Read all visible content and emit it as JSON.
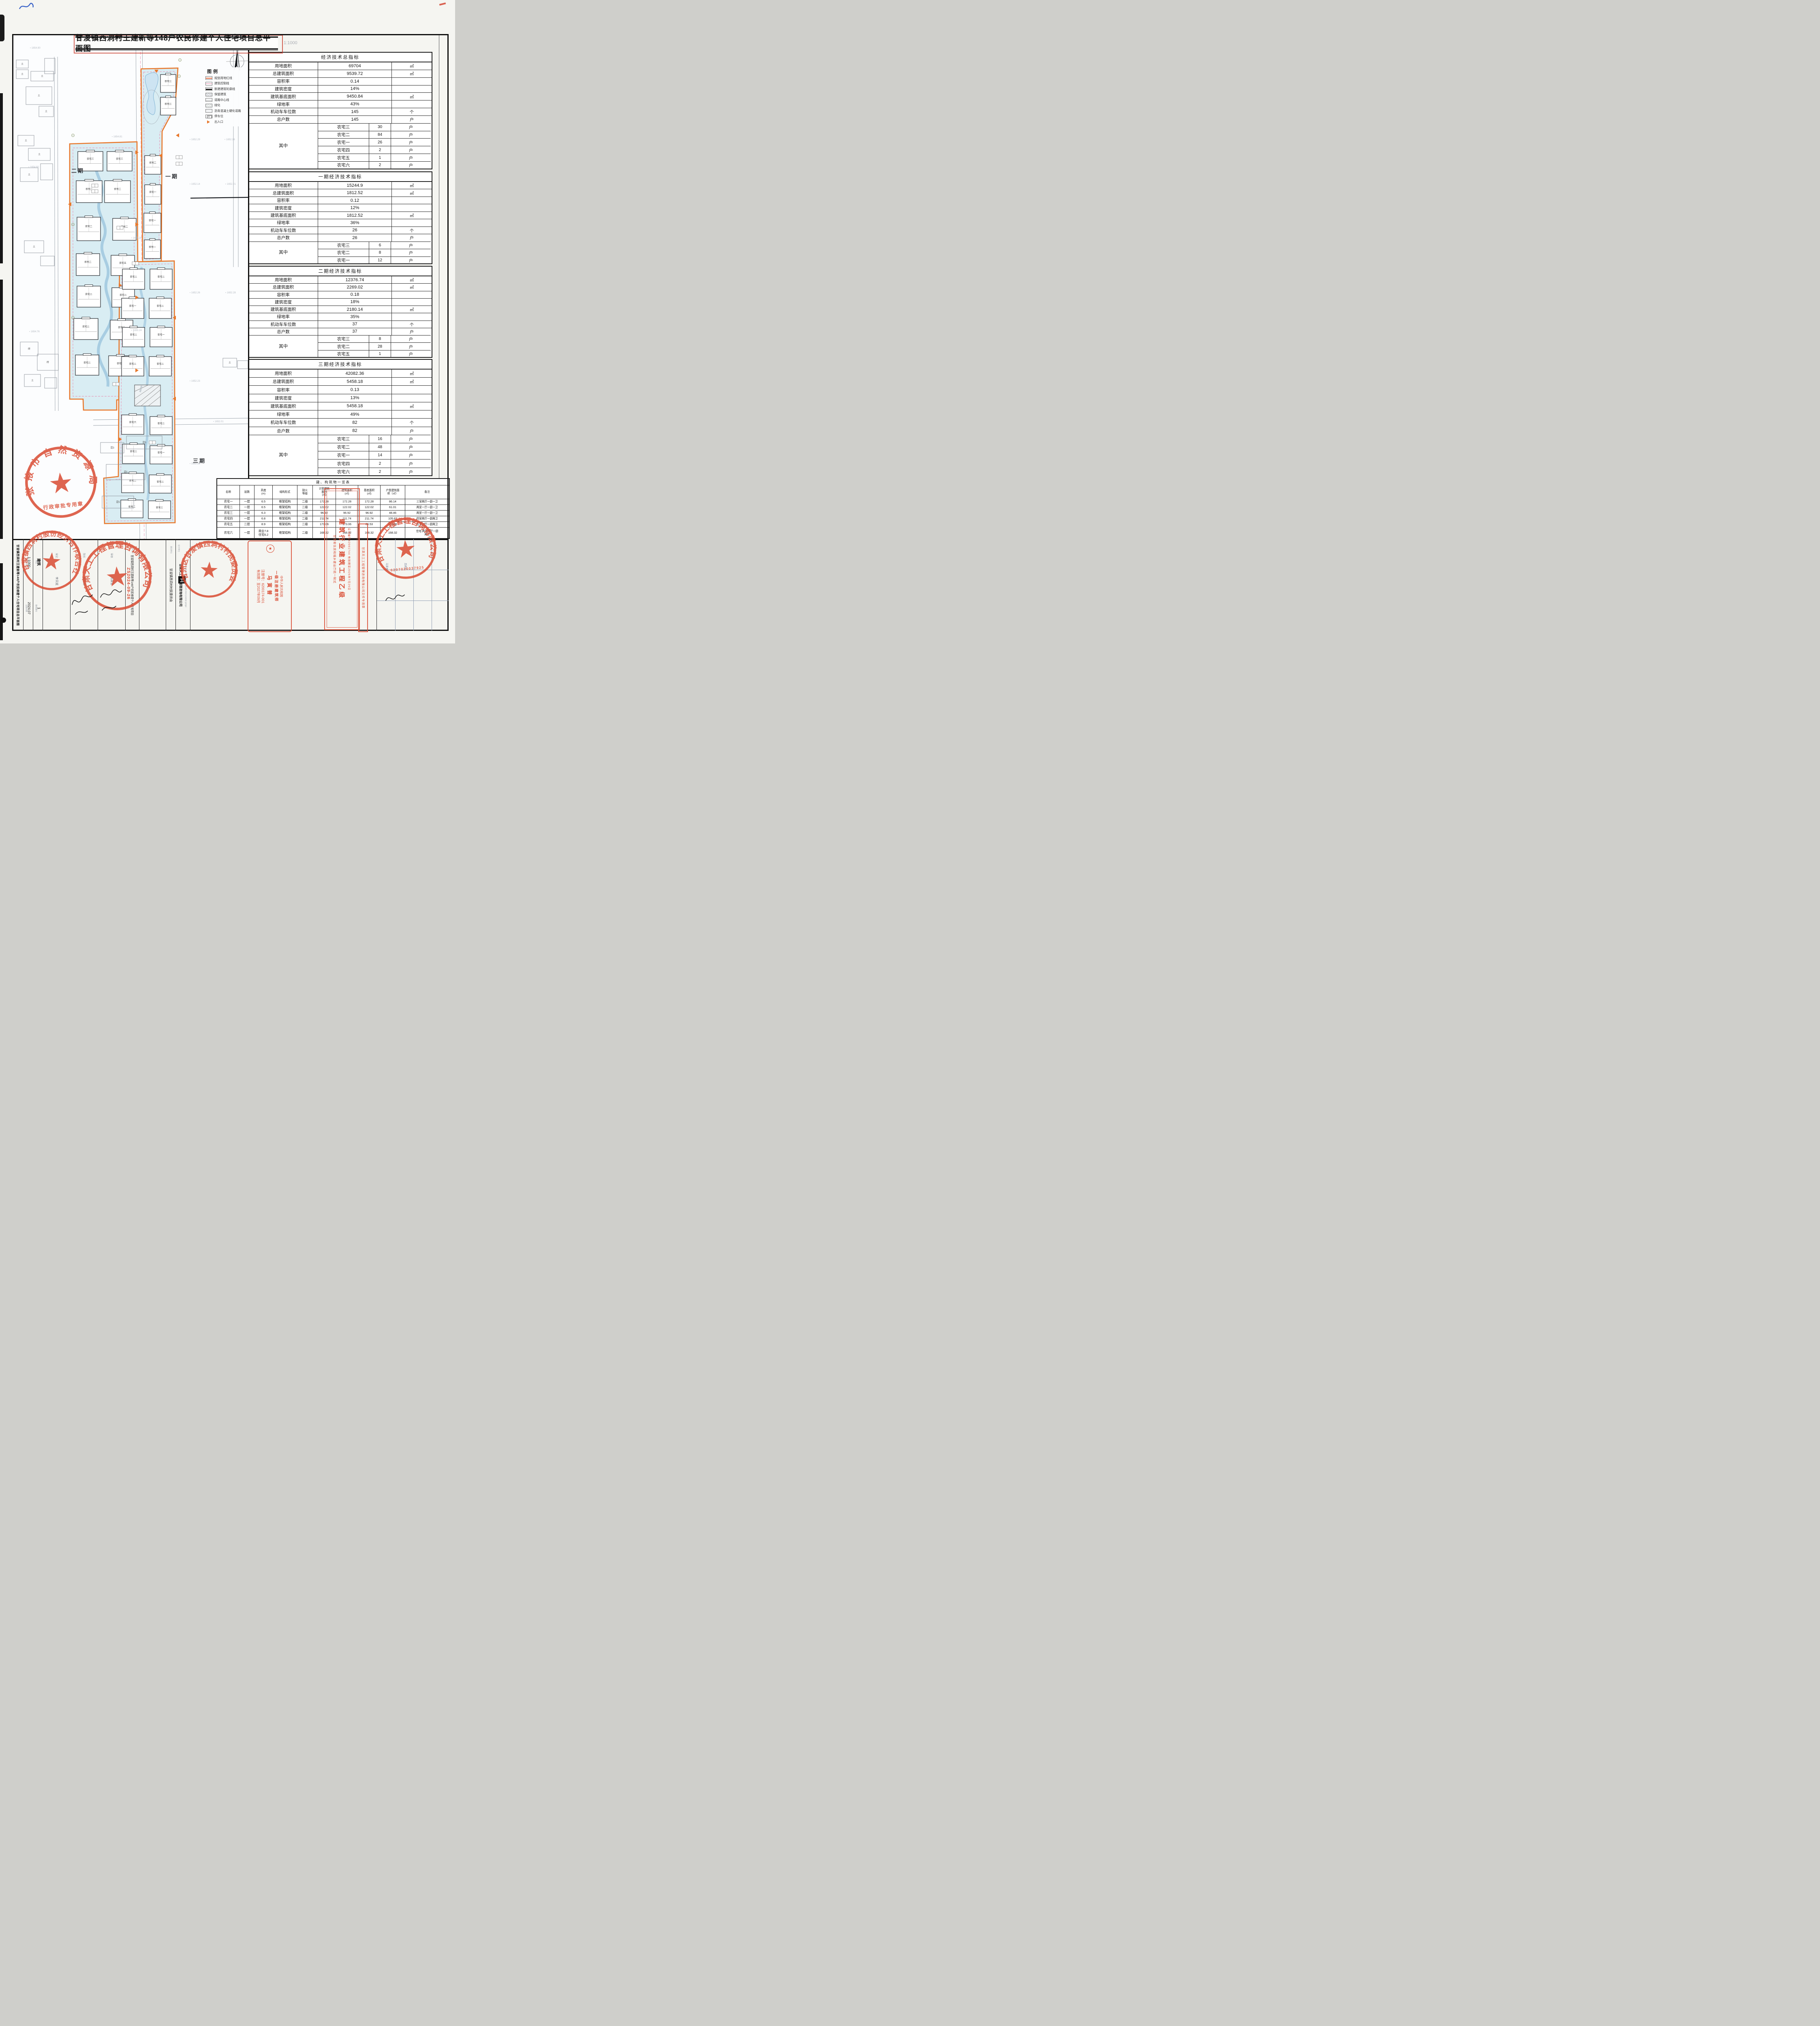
{
  "title": {
    "text": "甘浚镇西洞村王建新等148户农民修建个人住宅项目总平面图",
    "scale": "1:1000"
  },
  "north": "N",
  "legend": {
    "title": "图例",
    "items": [
      {
        "label": "规划用地红线",
        "type": "redline"
      },
      {
        "label": "建筑控制线",
        "type": "pinkline"
      },
      {
        "label": "新建建筑轮廓线",
        "type": "blackline"
      },
      {
        "label": "保留建筑",
        "type": "hatch"
      },
      {
        "label": "道路中心线",
        "type": "thinline"
      },
      {
        "label": "绿化",
        "type": "hatch2"
      },
      {
        "label": "沥青混凝土硬化道路",
        "type": "dots"
      },
      {
        "label": "停车位",
        "type": "parking"
      },
      {
        "label": "出入口",
        "type": "triangle"
      }
    ]
  },
  "map": {
    "phase_labels": [
      "二期",
      "一期",
      "三期"
    ],
    "houses": [
      "农宅三",
      "农宅三",
      "农宅二",
      "农宅二",
      "农宅二",
      "农宅二",
      "农宅二",
      "农宅五",
      "农宅二",
      "农宅二",
      "农宅二",
      "农宅三",
      "农宅二",
      "农宅二",
      "农宅三",
      "农宅三",
      "农宅二",
      "农宅一",
      "农宅一",
      "农宅一",
      "农宅二",
      "农宅二",
      "农宅一",
      "农宅二",
      "农宅二",
      "农宅一",
      "农宅二",
      "农宅二",
      "农宅六",
      "农宅二",
      "农宅二",
      "农宅一",
      "农宅二",
      "农宅二",
      "农宅二",
      "农宅三"
    ],
    "existing_labels": [
      "土",
      "砖",
      "混3",
      "混5"
    ],
    "elevations": [
      "1654.90",
      "1654.80",
      "1654.76",
      "1654.81",
      "1655.29",
      "1655.24",
      "1652.29",
      "1652.16",
      "1652.14",
      "1652.21",
      "1652.26",
      "1652.28",
      "1652.23",
      "1652.36",
      "1652.01"
    ],
    "road_label": "R6.00"
  },
  "indicator_tables": [
    {
      "title": "经济技术总指标",
      "rows": [
        [
          "用地面积",
          "69704",
          "㎡"
        ],
        [
          "总建筑面积",
          "9539.72",
          "㎡"
        ],
        [
          "容积率",
          "0.14",
          ""
        ],
        [
          "建筑密度",
          "14%",
          ""
        ],
        [
          "建筑基底面积",
          "9450.84",
          "㎡"
        ],
        [
          "绿地率",
          "43%",
          ""
        ],
        [
          "机动车车位数",
          "145",
          "个"
        ],
        [
          "总户数",
          "145",
          "户"
        ]
      ],
      "among_label": "其中",
      "among": [
        [
          "农宅三",
          "30",
          "户"
        ],
        [
          "农宅二",
          "84",
          "户"
        ],
        [
          "农宅一",
          "26",
          "户"
        ],
        [
          "农宅四",
          "2",
          "户"
        ],
        [
          "农宅五",
          "1",
          "户"
        ],
        [
          "农宅六",
          "2",
          "户"
        ]
      ]
    },
    {
      "title": "一期经济技术指标",
      "rows": [
        [
          "用地面积",
          "15244.9",
          "㎡"
        ],
        [
          "总建筑面积",
          "1812.52",
          "㎡"
        ],
        [
          "容积率",
          "0.12",
          ""
        ],
        [
          "建筑密度",
          "12%",
          ""
        ],
        [
          "建筑基底面积",
          "1812.52",
          "㎡"
        ],
        [
          "绿地率",
          "36%",
          ""
        ],
        [
          "机动车车位数",
          "26",
          "个"
        ],
        [
          "总户数",
          "26",
          "户"
        ]
      ],
      "among_label": "其中",
      "among": [
        [
          "农宅三",
          "6",
          "户"
        ],
        [
          "农宅二",
          "8",
          "户"
        ],
        [
          "农宅一",
          "12",
          "户"
        ]
      ]
    },
    {
      "title": "二期经济技术指标",
      "rows": [
        [
          "用地面积",
          "12376.74",
          "㎡"
        ],
        [
          "总建筑面积",
          "2269.02",
          "㎡"
        ],
        [
          "容积率",
          "0.18",
          ""
        ],
        [
          "建筑密度",
          "18%",
          ""
        ],
        [
          "建筑基底面积",
          "2180.14",
          "㎡"
        ],
        [
          "绿地率",
          "35%",
          ""
        ],
        [
          "机动车车位数",
          "37",
          "个"
        ],
        [
          "总户数",
          "37",
          "户"
        ]
      ],
      "among_label": "其中",
      "among": [
        [
          "农宅三",
          "8",
          "户"
        ],
        [
          "农宅二",
          "28",
          "户"
        ],
        [
          "农宅五",
          "1",
          "户"
        ]
      ]
    },
    {
      "title": "三期经济技术指标",
      "rows": [
        [
          "用地面积",
          "42082.36",
          "㎡"
        ],
        [
          "总建筑面积",
          "5458.18",
          "㎡"
        ],
        [
          "容积率",
          "0.13",
          ""
        ],
        [
          "建筑密度",
          "13%",
          ""
        ],
        [
          "建筑基底面积",
          "5458.18",
          "㎡"
        ],
        [
          "绿地率",
          "49%",
          ""
        ],
        [
          "机动车车位数",
          "82",
          "个"
        ],
        [
          "总户数",
          "82",
          "户"
        ]
      ],
      "among_label": "其中",
      "among": [
        [
          "农宅三",
          "16",
          "户"
        ],
        [
          "农宅二",
          "48",
          "户"
        ],
        [
          "农宅一",
          "14",
          "户"
        ],
        [
          "农宅四",
          "2",
          "户"
        ],
        [
          "农宅六",
          "2",
          "户"
        ]
      ]
    }
  ],
  "building_table": {
    "title": "建、构筑物一览表",
    "headers": [
      "名称",
      "层数",
      "高度\n(m)",
      "结构形式",
      "耐火\n等级",
      "计容建筑\n面积\n(㎡)",
      "建筑面积\n(㎡)",
      "基底面积\n(㎡)",
      "户型建筑面\n积（㎡）",
      "备注"
    ],
    "rows": [
      [
        "农宅一",
        "一层",
        "6.5",
        "框架结构",
        "二级",
        "172.28",
        "172.28",
        "172.28",
        "86.14",
        "三室两厅一厨一卫"
      ],
      [
        "农宅二",
        "一层",
        "6.5",
        "框架结构",
        "二级",
        "122.02",
        "122.02",
        "122.02",
        "61.01",
        "两室一厅一厨一卫"
      ],
      [
        "农宅三",
        "一层",
        "6.3",
        "框架结构",
        "二级",
        "96.92",
        "96.92",
        "96.92",
        "48.46",
        "两室一厅一厨一卫"
      ],
      [
        "农宅四",
        "一层",
        "6.8",
        "框架结构",
        "二级",
        "211.74",
        "211.74",
        "211.74",
        "105.87",
        "四室两厅一厨两卫"
      ],
      [
        "农宅五",
        "二层",
        "8.9",
        "框架结构",
        "二级",
        "173.06",
        "173.06",
        "86.53",
        "173.06",
        "五室三厅一厨两卫"
      ],
      [
        "农宅六",
        "一层",
        "商业7.8\n住宅6.2",
        "框架结构",
        "二级",
        "168.32",
        "168.32",
        "168.32",
        "168.32",
        "住宅:两室两厅一厨\n两卫"
      ]
    ]
  },
  "title_block": {
    "drawing_name": "甘浚镇西洞村王建新等148户农民修建个人住宅项目总平面图",
    "fields": [
      {
        "label": "图纸比例",
        "value": "1:1000"
      },
      {
        "label": "专业",
        "value": "建筑"
      },
      {
        "label": "出图日期",
        "value": "2024.07"
      },
      {
        "label": "图纸编号",
        "value": "1"
      }
    ],
    "roles": [
      {
        "role": "审定",
        "name": "李天斌"
      },
      {
        "role": "院长",
        "name": "韩多创"
      },
      {
        "role": "审核",
        "name": "马寅普"
      }
    ],
    "project_label": "项目名称",
    "project_name": "甘浚镇西洞村王建新等148户农民修建个人住宅项目",
    "owner_label": "建设单位",
    "owner": "甘浚镇西洞村村民委员会",
    "designer_label": "设计单位",
    "designer": "甘肃天工工程管理咨询有限公司",
    "designer_pinyin": "Gansu tiangong gongcheng guanli zixun youxian gongsi",
    "logo_char": "工",
    "extra_names": [
      "马寅普",
      "吴耕耘"
    ]
  },
  "stamps": {
    "zs_number": "ZS2024-09-26",
    "circular": [
      {
        "ring": "张掖市自然资源局",
        "bottom": "行政审批专用章"
      },
      {
        "ring": "甘浚镇西洞村股份经济合作联合社",
        "bottom": ""
      },
      {
        "ring": "甘肃天工工程管理咨询有限公司",
        "bottom": ""
      },
      {
        "ring": "甘州区甘浚镇西洞村村民委员会",
        "bottom": ""
      },
      {
        "ring": "甘肃天工工程管理咨询有限公司",
        "bottom": "6207020037925"
      }
    ],
    "architect": {
      "line1": "中华人民共和国",
      "line2": "一级注册建筑师",
      "name": "马寅普",
      "reg": "注册号：6200174-001",
      "valid": "有效期：至2027年09月"
    },
    "qualification": {
      "big": "建筑行业建筑工程乙级",
      "top": "证书编号62001744  有效期至2026年7月29日",
      "bottom": "甘肃省住房和城乡建设厅统一制式"
    },
    "file_stamp": "甘肃天工工程管理咨询有限公司文件专用章"
  }
}
